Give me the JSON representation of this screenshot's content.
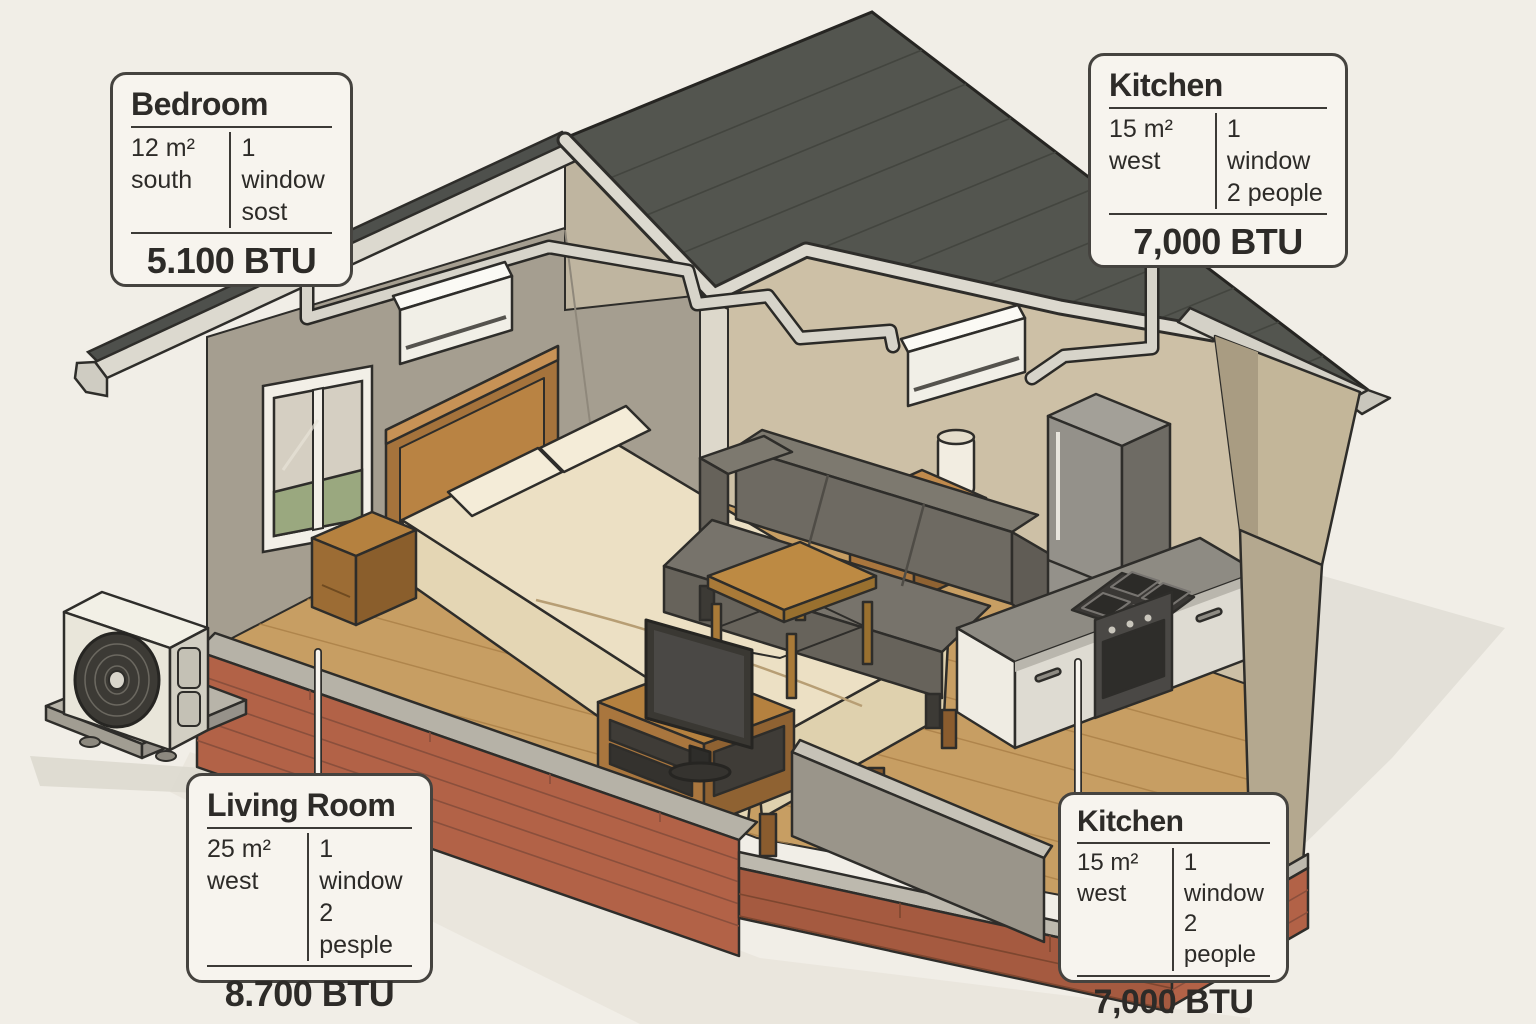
{
  "illustration": {
    "description": "Isometric cutaway house showing air-conditioning BTU requirements per room",
    "rooms": [
      "Bedroom",
      "Living Room",
      "Kitchen"
    ],
    "objects": [
      "roof",
      "bedroom-window",
      "bed",
      "nightstand",
      "lamp",
      "stool",
      "sofa",
      "coffee-table",
      "tv",
      "tv-stand",
      "fridge",
      "kitchen-counter",
      "stove",
      "oven",
      "indoor-ac-unit-bedroom",
      "indoor-ac-unit-kitchen",
      "outdoor-ac-condenser",
      "refrigerant-pipes",
      "brick-foundation"
    ],
    "colors": {
      "background": "#f1eee7",
      "roof": "#53554f",
      "fascia": "#dcd9cf",
      "wall_gray": "#a59e90",
      "wall_tan": "#cdc0a6",
      "floor_wood": "#c79e63",
      "brick": "#b26247",
      "pipe": "#d7d4ca",
      "label_bg": "#f7f4ee",
      "label_border": "#45433f",
      "text": "#2d2b28"
    }
  },
  "labels": {
    "bedroom": {
      "title": "Bedroom",
      "area": "12 m²",
      "orientation": "south",
      "windows": "1 window",
      "occupants": "sost",
      "btu": "5.100 BTU"
    },
    "kitchen_top": {
      "title": "Kitchen",
      "area": "15 m²",
      "orientation": "west",
      "windows": "1 window",
      "occupants": "2 people",
      "btu": "7,000 BTU"
    },
    "living_room": {
      "title": "Living Room",
      "area": "25 m²",
      "orientation": "west",
      "windows": "1 window",
      "occupants": "2 pesple",
      "btu": "8.700 BTU"
    },
    "kitchen_bottom": {
      "title": "Kitchen",
      "area": "15 m²",
      "orientation": "west",
      "windows": "1 window",
      "occupants": "2 people",
      "btu": "7,000 BTU"
    }
  }
}
